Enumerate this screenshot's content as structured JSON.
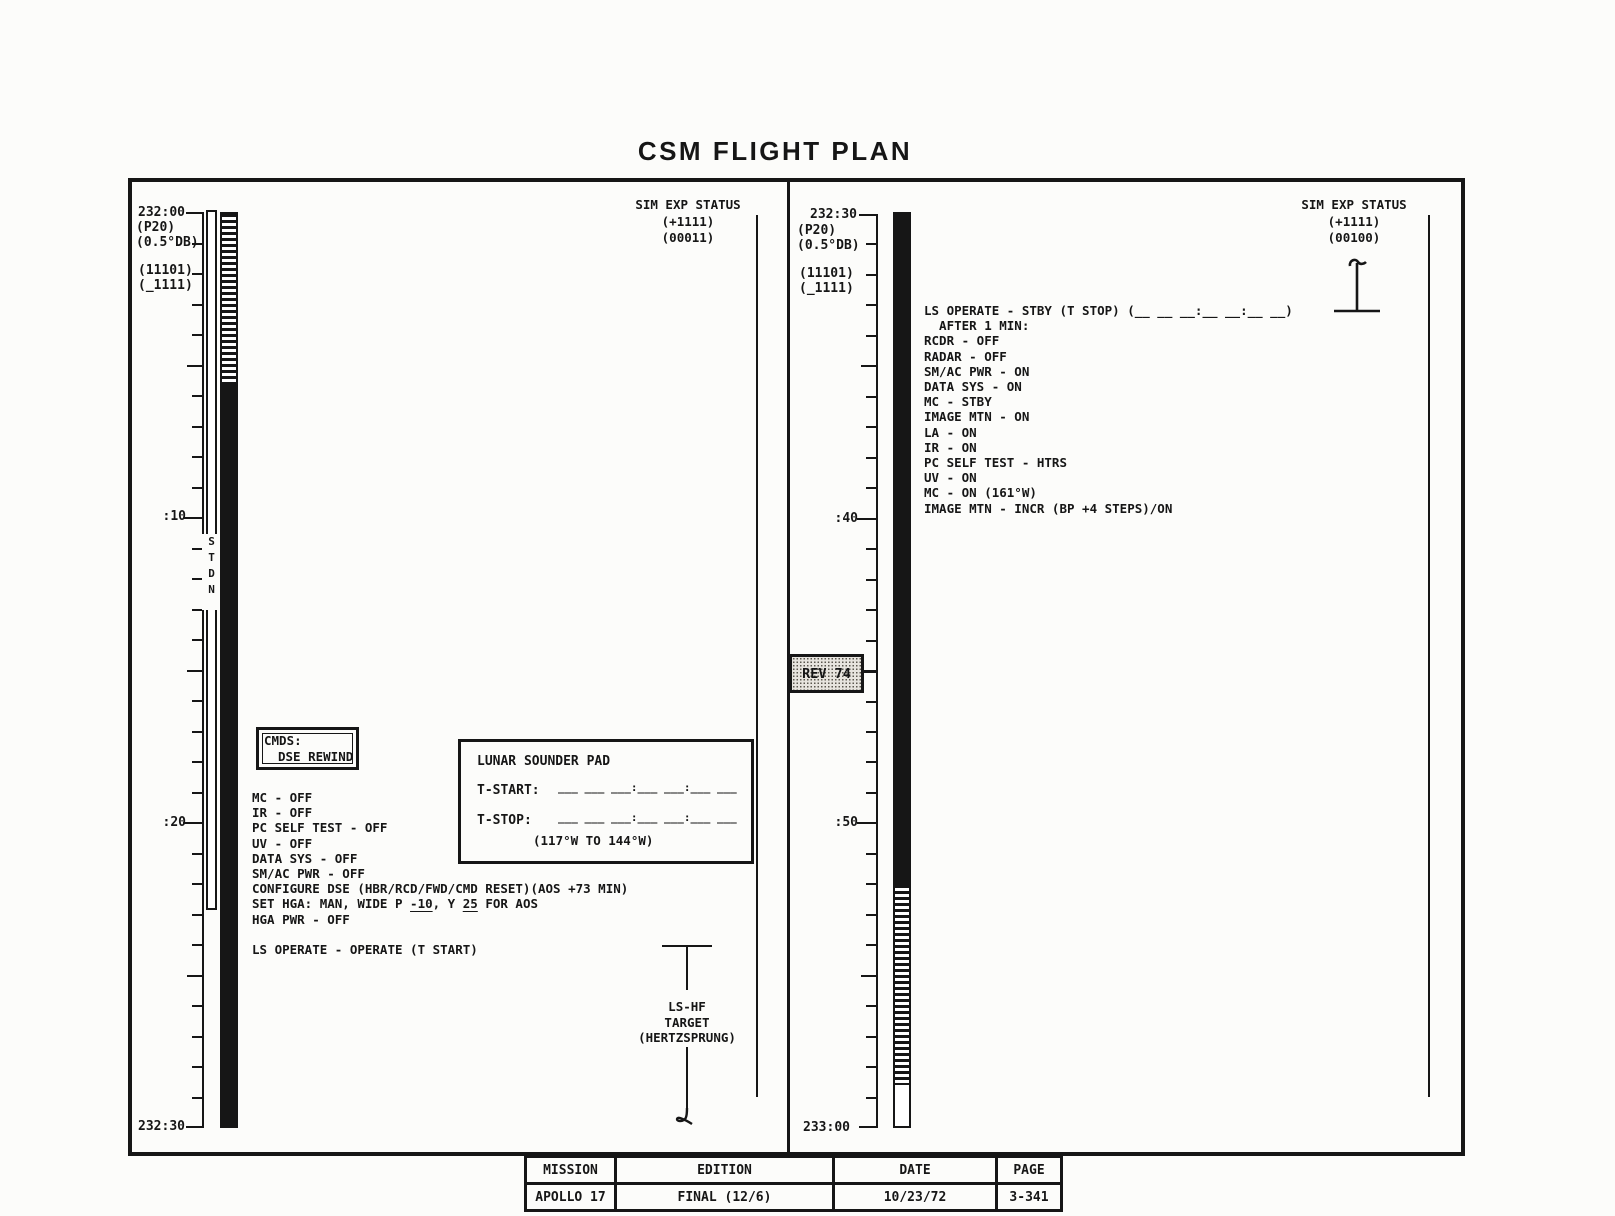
{
  "title": "CSM FLIGHT PLAN",
  "left_panel": {
    "timeline": {
      "top_label": "232:00",
      "p20": "(P20)",
      "db": "(0.5°DB)",
      "code1": "(11101)",
      "code2": "(_1111)",
      "mid1": ":10",
      "mid2": ":20",
      "bottom_label": "232:30",
      "stdn": "S\nT\nD\nN"
    },
    "sim_exp_status": "SIM EXP STATUS\n(+1111)\n(00011)",
    "cmds_box": {
      "line1": "CMDS:",
      "line2": "DSE REWIND"
    },
    "procedure_lines": [
      "MC - OFF",
      "IR - OFF",
      "PC SELF TEST - OFF",
      "UV - OFF",
      "DATA SYS - OFF",
      "SM/AC PWR - OFF",
      "CONFIGURE DSE (HBR/RCD/FWD/CMD RESET)(AOS +73 MIN)",
      [
        {
          "t": "SET HGA: MAN, WIDE P "
        },
        {
          "t": "-10",
          "u": true
        },
        {
          "t": ", Y "
        },
        {
          "t": "25",
          "u": true
        },
        {
          "t": " FOR AOS"
        }
      ],
      "HGA PWR - OFF",
      "",
      "LS OPERATE - OPERATE (T START)"
    ],
    "lunar_sounder_pad": {
      "title": "LUNAR SOUNDER PAD",
      "t_start_label": "T-START:",
      "t_stop_label": "T-STOP:",
      "blank_pattern": "___ ___ ___:___ ___:___ ___",
      "range_note": "(117°W TO 144°W)"
    },
    "ls_hf_target": "LS-HF\nTARGET\n(HERTZSPRUNG)"
  },
  "right_panel": {
    "timeline": {
      "top_label": "232:30",
      "p20": "(P20)",
      "db": "(0.5°DB)",
      "code1": "(11101)",
      "code2": "(_1111)",
      "mid1": ":40",
      "mid2": ":50",
      "bottom_label": "233:00"
    },
    "sim_exp_status": "SIM EXP STATUS\n(+1111)\n(00100)",
    "rev_label": "REV 74",
    "procedure_lines": [
      "LS OPERATE - STBY (T STOP) (__ __ __:__ __:__ __)",
      "  AFTER 1 MIN:",
      "RCDR - OFF",
      "RADAR - OFF",
      "SM/AC PWR - ON",
      "DATA SYS - ON",
      "MC - STBY",
      "IMAGE MTN - ON",
      "LA - ON",
      "IR - ON",
      "PC SELF TEST - HTRS",
      "UV - ON",
      "MC - ON (161°W)",
      "IMAGE MTN - INCR (BP +4 STEPS)/ON"
    ]
  },
  "footer_table": {
    "headers": [
      "MISSION",
      "EDITION",
      "DATE",
      "PAGE"
    ],
    "values": [
      "APOLLO 17",
      "FINAL (12/6)",
      "10/23/72",
      "3-341"
    ]
  }
}
